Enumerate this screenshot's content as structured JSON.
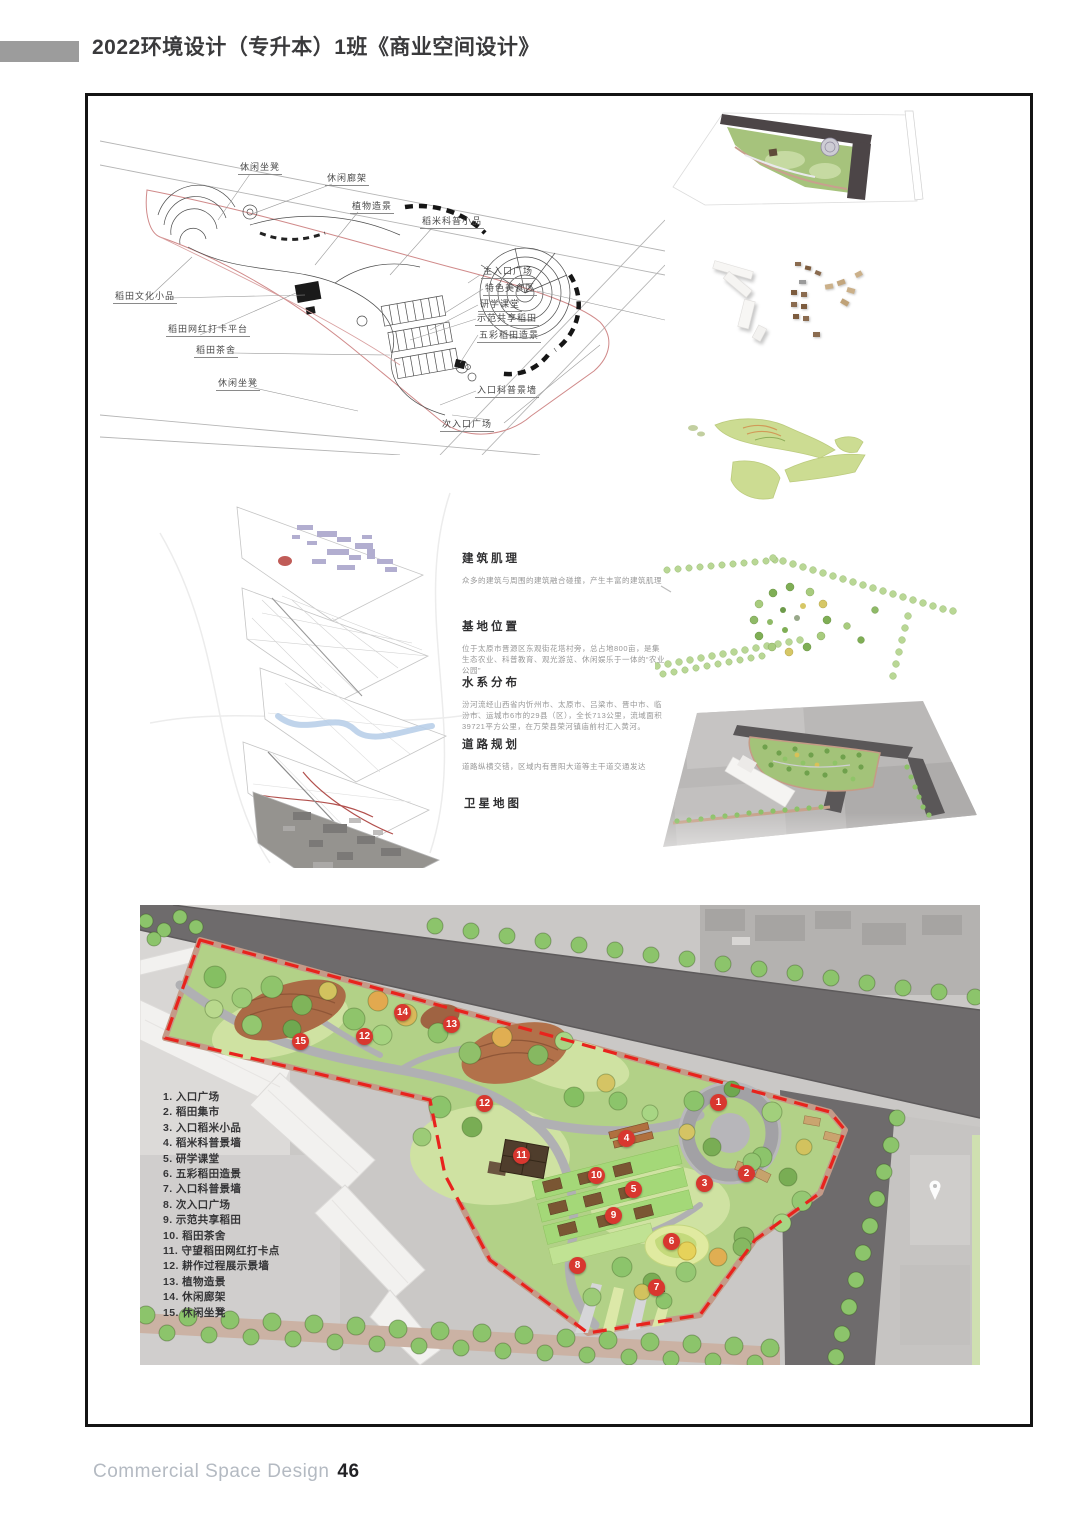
{
  "header": {
    "title": "2022环境设计（专升本）1班《商业空间设计》"
  },
  "footer": {
    "label": "Commercial Space Design",
    "page_number": "46"
  },
  "line_plan": {
    "labels": [
      "休闲坐凳",
      "休闲廊架",
      "植物造景",
      "稻米科普小品",
      "主入口广场",
      "特色美食区",
      "研学课堂",
      "示范共享稻田",
      "五彩稻田造景",
      "入口科普景墙",
      "次入口广场",
      "稻田文化小品",
      "稻田网红打卡平台",
      "稻田茶舍",
      "休闲坐凳"
    ]
  },
  "analysis": {
    "sections": [
      {
        "heading": "建筑肌理",
        "desc": "众多的建筑与周围的建筑融合碰撞，产生丰富的建筑肌理"
      },
      {
        "heading": "基地位置",
        "desc": "位于太原市晋源区东观街花塔村旁，总占地800亩，是集生态农业、科普教育、观光游览、休闲娱乐于一体的“农业公园”"
      },
      {
        "heading": "水系分布",
        "desc": "汾河流经山西省内忻州市、太原市、吕梁市、晋中市、临汾市、运城市6市的29县（区），全长713公里，流域面积39721平方公里，在万荣县荣河镇庙前村汇入黄河。"
      },
      {
        "heading": "道路规划",
        "desc": "道路纵横交错，区域内有晋阳大道等主干道交通发达"
      },
      {
        "heading": "卫星地图",
        "desc": ""
      }
    ]
  },
  "master_plan": {
    "legend": [
      "1. 入口广场",
      "2. 稻田集市",
      "3. 入口稻米小品",
      "4. 稻米科普景墙",
      "5. 研学课堂",
      "6. 五彩稻田造景",
      "7. 入口科普景墙",
      "8. 次入口广场",
      "9. 示范共享稻田",
      "10. 稻田茶舍",
      "11. 守望稻田网红打卡点",
      "12. 耕作过程展示景墙",
      "13. 植物造景",
      "14. 休闲廊架",
      "15. 休闲坐凳"
    ],
    "markers": [
      "15",
      "12",
      "14",
      "13",
      "12",
      "1",
      "4",
      "11",
      "2",
      "3",
      "10",
      "5",
      "9",
      "6",
      "8",
      "7"
    ]
  },
  "icons": {
    "map_pin": "map-pin"
  },
  "colors": {
    "marker_red": "#d8372f",
    "boundary_dash_red": "#e8231d",
    "road_gray": "#6e6b6c",
    "park_green": "#b2d187",
    "tree_green": "#8cc46b",
    "frame_black": "#141414",
    "header_bar_gray": "#9c9c9c",
    "footer_gray": "#b4bac2"
  }
}
